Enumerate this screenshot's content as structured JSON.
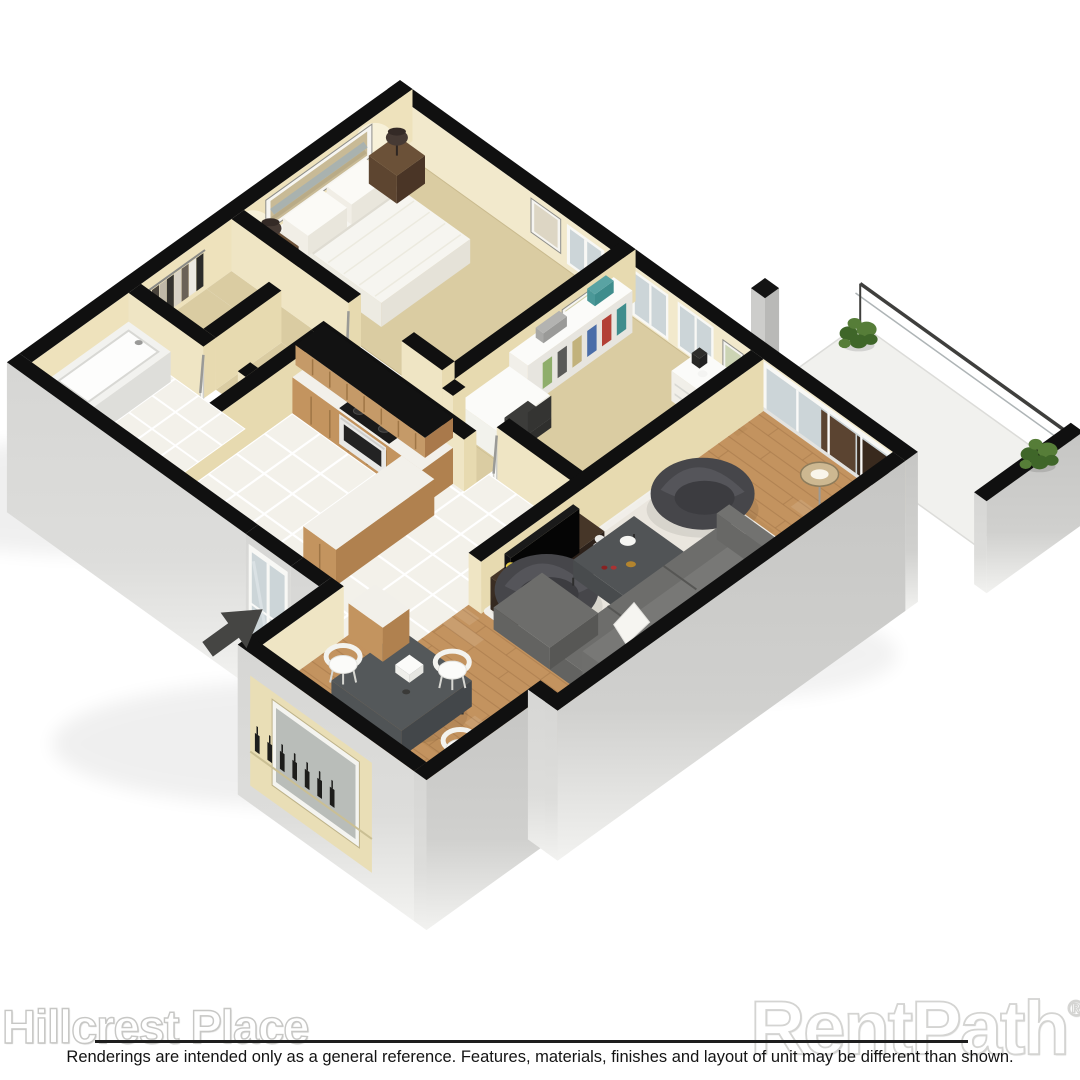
{
  "image_type": "3d-isometric-apartment-floor-plan-rendering",
  "watermarks": {
    "property_name": "Hillcrest Place",
    "brand": "RentPath",
    "registered_mark": "®"
  },
  "disclaimer": "Renderings are intended only as a general reference. Features, materials, finishes and layout of unit may be different than shown.",
  "floor_plan": {
    "rooms": [
      "master-bedroom",
      "office-bedroom",
      "hallway",
      "walk-in-closet",
      "bathroom",
      "kitchen",
      "living-room",
      "dining-area",
      "balcony",
      "entry-porch"
    ],
    "entry_indicator": "arrow"
  },
  "colors": {
    "outline": "#101010",
    "wall": "#efe5c4",
    "wallShade": "#e7dab0",
    "wallNE": "#f2e9cc",
    "wallNW": "#eee2bc",
    "carpet": "#dacca2",
    "carpetEdge": "#c9ba8e",
    "tile": "#f3f1ea",
    "grout": "#ffffff",
    "wood": "#c3935f",
    "woodLine": "#a97c4e",
    "rug": "#ece9e3",
    "bedTop": "#f6f5f0",
    "cabinet": "#c3945f",
    "cabinetDark": "#9f7646",
    "counter": "#f2f0ea",
    "sofa": "#6d6d6b",
    "sofaDark": "#575755",
    "charcoal": "#46464a",
    "tableTop": "#54585a",
    "white": "#fbfbf9",
    "glass": "#ccd5d8",
    "frame": "#f8f8f5",
    "plant": "#567d38",
    "plantDark": "#3f6629",
    "lampShade": "#cdb891",
    "arrow": "#454543",
    "brown": "#5b4431",
    "brownDark": "#392a1e",
    "nightstand": "#5b4430",
    "extTopL": "#d6d6d4",
    "extTopR": "#c6c6c4",
    "extFade": "#f2f2f0"
  }
}
